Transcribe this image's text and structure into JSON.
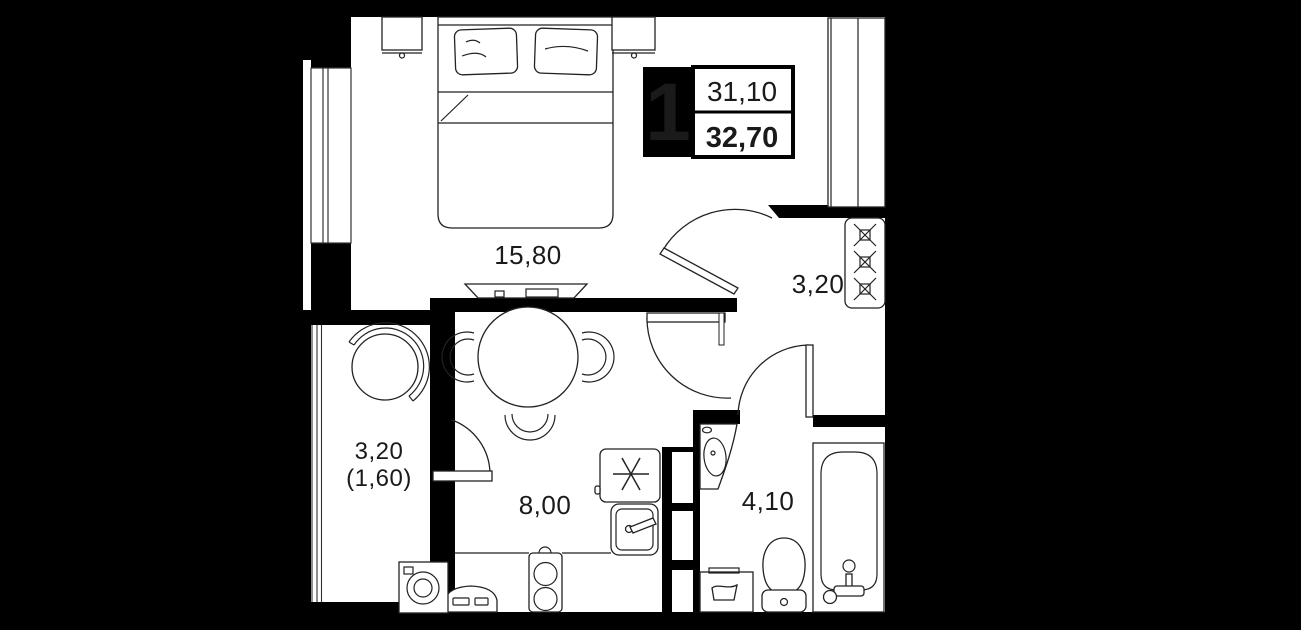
{
  "plan": {
    "type": "apartment-floor-plan",
    "info_box": {
      "room_count": "1",
      "area_living": "31,10",
      "area_total": "32,70"
    },
    "labels": {
      "bedroom": "15,80",
      "hallway": "3,20",
      "kitchen": "8,00",
      "bathroom": "4,10",
      "balcony_primary": "3,20",
      "balcony_secondary": "(1,60)"
    },
    "colors": {
      "background": "#000000",
      "walls": "#000000",
      "floor": "#ffffff",
      "line": "#222222",
      "text": "#1a1a1a"
    }
  }
}
